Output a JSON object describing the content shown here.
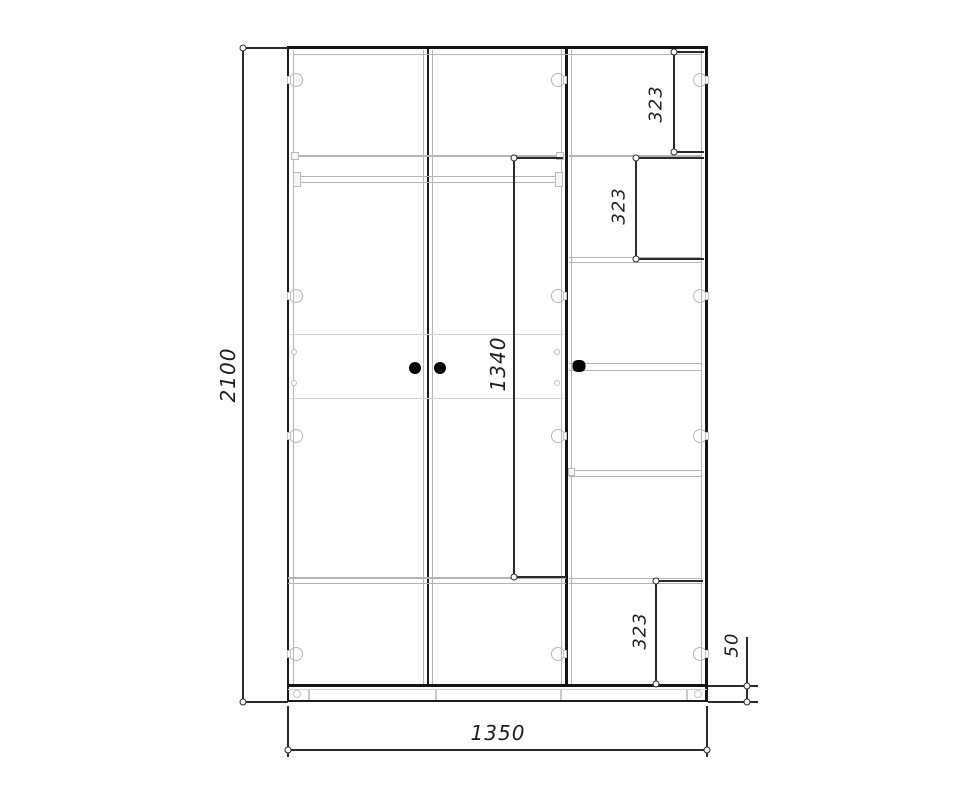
{
  "drawing": {
    "title": "wardrobe-front-elevation",
    "dimensions": {
      "overall_height": "2100",
      "overall_width": "1350",
      "hanging_space_height": "1340",
      "top_section_height": "323",
      "second_section_height": "323",
      "bottom_section_height": "323",
      "plinth_height": "50"
    },
    "colors": {
      "line_dark": "#1c1c1c",
      "line_gray": "#b4b4b4",
      "line_light": "#d2d2d2",
      "dimension": "#2b2b2b",
      "knob": "#000000",
      "background": "#ffffff"
    }
  }
}
